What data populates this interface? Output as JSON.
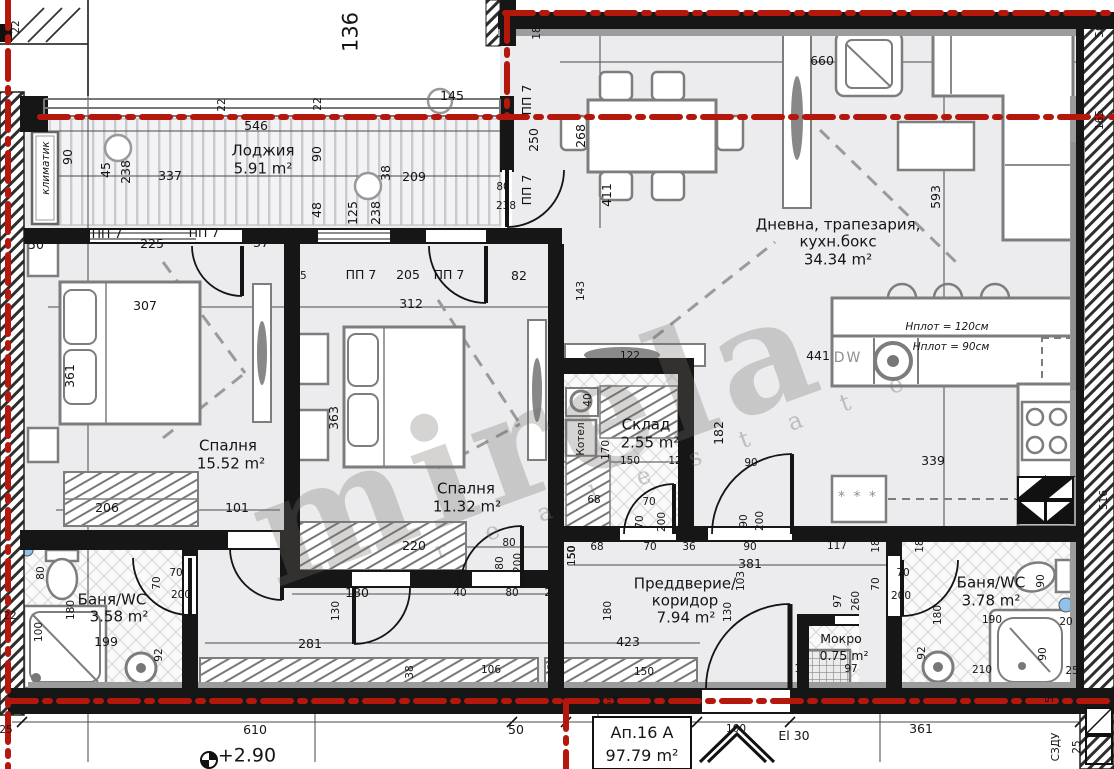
{
  "plan": {
    "apartment": {
      "name": "Ап.16 А",
      "total_area": "97.79 m²",
      "level": "+2.90",
      "entry_door_rating": "El 30"
    },
    "rooms": [
      {
        "name": "Лоджия",
        "area": "5.91 m²"
      },
      {
        "name": "Дневна, трапезария, кухн.бокс",
        "area": "34.34 m²"
      },
      {
        "name": "Спалня",
        "area": "15.52 m²"
      },
      {
        "name": "Спалня",
        "area": "11.32 m²"
      },
      {
        "name": "Склад",
        "area": "2.55 m²"
      },
      {
        "name": "Преддверие/коридор",
        "area": "7.94 m²"
      },
      {
        "name": "Баня/WC",
        "area": "3.58 m²"
      },
      {
        "name": "Баня/WC",
        "area": "3.78 m²"
      },
      {
        "name": "Мокро",
        "area": "0.75 m²"
      }
    ]
  },
  "colors": {
    "boundary_red": "#b5170d",
    "wall": "#161616",
    "furniture": "#7d7d7d"
  },
  "watermark": {
    "main": "mirela",
    "sub": "r e a l   e s t a t e"
  },
  "labels": [
    {
      "t": "22",
      "x": 16,
      "y": 27,
      "r": -90,
      "c": "sm"
    },
    {
      "t": "136",
      "x": 351,
      "y": 32,
      "r": -90,
      "c": "big"
    },
    {
      "t": "145",
      "x": 452,
      "y": 96
    },
    {
      "t": "546",
      "x": 256,
      "y": 126
    },
    {
      "t": "22",
      "x": 222,
      "y": 105,
      "r": -90,
      "c": "sm"
    },
    {
      "t": "22",
      "x": 318,
      "y": 104,
      "r": -90,
      "c": "sm"
    },
    {
      "t": "климатик",
      "x": 46,
      "y": 168,
      "r": -90,
      "c": "it",
      "n": "ac-unit-label"
    },
    {
      "t": "90",
      "x": 68,
      "y": 157,
      "r": -90
    },
    {
      "t": "45",
      "x": 106,
      "y": 170,
      "r": -90
    },
    {
      "t": "238",
      "x": 126,
      "y": 172,
      "r": -90
    },
    {
      "t": "337",
      "x": 170,
      "y": 176
    },
    {
      "t": "Лоджия",
      "x": 263,
      "y": 151,
      "c": "rm",
      "n": "room-label"
    },
    {
      "t": "5.91 m²",
      "x": 263,
      "y": 169,
      "c": "rm",
      "n": "room-area"
    },
    {
      "t": "90",
      "x": 317,
      "y": 154,
      "r": -90
    },
    {
      "t": "38",
      "x": 386,
      "y": 173,
      "r": -90
    },
    {
      "t": "209",
      "x": 414,
      "y": 177
    },
    {
      "t": "48",
      "x": 317,
      "y": 210,
      "r": -90
    },
    {
      "t": "125",
      "x": 353,
      "y": 213,
      "r": -90
    },
    {
      "t": "238",
      "x": 376,
      "y": 213,
      "r": -90
    },
    {
      "t": "80",
      "x": 503,
      "y": 187,
      "c": "sm"
    },
    {
      "t": "238",
      "x": 506,
      "y": 206,
      "c": "sm"
    },
    {
      "t": "ПП 7",
      "x": 527,
      "y": 100,
      "r": -90,
      "n": "opening-label"
    },
    {
      "t": "250",
      "x": 534,
      "y": 140,
      "r": -90
    },
    {
      "t": "ПП 7",
      "x": 527,
      "y": 190,
      "r": -90,
      "n": "opening-label"
    },
    {
      "t": "18",
      "x": 537,
      "y": 33,
      "r": -90,
      "c": "sm"
    },
    {
      "t": "57",
      "x": 552,
      "y": 236
    },
    {
      "t": "660",
      "x": 822,
      "y": 61
    },
    {
      "t": "268",
      "x": 581,
      "y": 136,
      "r": -90
    },
    {
      "t": "411",
      "x": 607,
      "y": 195,
      "r": -90
    },
    {
      "t": "593",
      "x": 936,
      "y": 197,
      "r": -90
    },
    {
      "t": "82",
      "x": 519,
      "y": 276
    },
    {
      "t": "Дневна, трапезария,",
      "x": 838,
      "y": 225,
      "c": "rm",
      "n": "room-label"
    },
    {
      "t": "кухн.бокс",
      "x": 838,
      "y": 242,
      "c": "rm"
    },
    {
      "t": "34.34 m²",
      "x": 838,
      "y": 260,
      "c": "rm",
      "n": "room-area"
    },
    {
      "t": "143",
      "x": 581,
      "y": 291,
      "r": -90,
      "c": "sm"
    },
    {
      "t": "122",
      "x": 630,
      "y": 356,
      "c": "sm"
    },
    {
      "t": "441",
      "x": 818,
      "y": 356
    },
    {
      "t": "DW",
      "x": 848,
      "y": 358,
      "c": "gray",
      "n": "dishwasher-label"
    },
    {
      "t": "Hплот = 120см",
      "x": 947,
      "y": 327,
      "c": "it",
      "n": "counter-height-label"
    },
    {
      "t": "Hплот = 90см",
      "x": 951,
      "y": 347,
      "c": "it",
      "n": "counter-height-label"
    },
    {
      "t": "339",
      "x": 933,
      "y": 461
    },
    {
      "t": "* * *",
      "x": 858,
      "y": 497,
      "c": "gray",
      "n": "fridge-label"
    },
    {
      "t": "50",
      "x": 36,
      "y": 245
    },
    {
      "t": "ПП 7",
      "x": 107,
      "y": 234,
      "n": "opening-label"
    },
    {
      "t": "225",
      "x": 152,
      "y": 244
    },
    {
      "t": "ПП 7",
      "x": 204,
      "y": 233,
      "n": "opening-label"
    },
    {
      "t": "37",
      "x": 261,
      "y": 243
    },
    {
      "t": "307",
      "x": 145,
      "y": 306
    },
    {
      "t": "361",
      "x": 70,
      "y": 376,
      "r": -90
    },
    {
      "t": "Спалня",
      "x": 228,
      "y": 446,
      "c": "rm",
      "n": "room-label"
    },
    {
      "t": "15.52 m²",
      "x": 231,
      "y": 464,
      "c": "rm",
      "n": "room-area"
    },
    {
      "t": "206",
      "x": 107,
      "y": 508
    },
    {
      "t": "101",
      "x": 237,
      "y": 508
    },
    {
      "t": "281",
      "x": 310,
      "y": 644
    },
    {
      "t": "199",
      "x": 106,
      "y": 642
    },
    {
      "t": "25",
      "x": 300,
      "y": 276,
      "c": "sm"
    },
    {
      "t": "ПП 7",
      "x": 361,
      "y": 275,
      "n": "opening-label"
    },
    {
      "t": "205",
      "x": 408,
      "y": 275
    },
    {
      "t": "ПП 7",
      "x": 449,
      "y": 275,
      "n": "opening-label"
    },
    {
      "t": "312",
      "x": 411,
      "y": 304
    },
    {
      "t": "363",
      "x": 334,
      "y": 418,
      "r": -90
    },
    {
      "t": "Спалня",
      "x": 466,
      "y": 489,
      "c": "rm",
      "n": "room-label"
    },
    {
      "t": "11.32 m²",
      "x": 467,
      "y": 507,
      "c": "rm",
      "n": "room-area"
    },
    {
      "t": "220",
      "x": 414,
      "y": 546
    },
    {
      "t": "80",
      "x": 509,
      "y": 543,
      "c": "sm"
    },
    {
      "t": "80",
      "x": 500,
      "y": 563,
      "r": -90,
      "c": "sm"
    },
    {
      "t": "200",
      "x": 518,
      "y": 563,
      "r": -90,
      "c": "sm"
    },
    {
      "t": "180",
      "x": 357,
      "y": 593
    },
    {
      "t": "40",
      "x": 460,
      "y": 593,
      "c": "sm"
    },
    {
      "t": "80",
      "x": 512,
      "y": 593,
      "c": "sm"
    },
    {
      "t": "24",
      "x": 551,
      "y": 593,
      "c": "sm"
    },
    {
      "t": "130",
      "x": 336,
      "y": 611,
      "r": -90,
      "c": "sm"
    },
    {
      "t": "38",
      "x": 410,
      "y": 672,
      "r": -90,
      "c": "sm"
    },
    {
      "t": "Склад",
      "x": 646,
      "y": 425,
      "c": "rm",
      "n": "room-label"
    },
    {
      "t": "2.55 m²",
      "x": 650,
      "y": 443,
      "c": "rm",
      "n": "room-area"
    },
    {
      "t": "182",
      "x": 719,
      "y": 433,
      "r": -90
    },
    {
      "t": "150",
      "x": 630,
      "y": 461,
      "c": "sm"
    },
    {
      "t": "12",
      "x": 675,
      "y": 461,
      "c": "sm"
    },
    {
      "t": "170",
      "x": 606,
      "y": 450,
      "r": -90,
      "c": "sm"
    },
    {
      "t": "40",
      "x": 588,
      "y": 400,
      "r": -90,
      "c": "sm"
    },
    {
      "t": "Котел",
      "x": 581,
      "y": 439,
      "r": -90,
      "c": "sm",
      "n": "boiler-label"
    },
    {
      "t": "68",
      "x": 594,
      "y": 500,
      "c": "sm"
    },
    {
      "t": "68",
      "x": 597,
      "y": 547,
      "c": "sm"
    },
    {
      "t": "50",
      "x": 572,
      "y": 552,
      "r": -90,
      "c": "sm"
    },
    {
      "t": "90",
      "x": 751,
      "y": 463,
      "c": "sm"
    },
    {
      "t": "70",
      "x": 649,
      "y": 502,
      "c": "sm"
    },
    {
      "t": "70",
      "x": 640,
      "y": 522,
      "r": -90,
      "c": "sm"
    },
    {
      "t": "200",
      "x": 662,
      "y": 522,
      "r": -90,
      "c": "sm"
    },
    {
      "t": "70",
      "x": 650,
      "y": 547,
      "c": "sm"
    },
    {
      "t": "36",
      "x": 689,
      "y": 547,
      "c": "sm"
    },
    {
      "t": "90",
      "x": 744,
      "y": 521,
      "r": -90,
      "c": "sm"
    },
    {
      "t": "200",
      "x": 760,
      "y": 521,
      "r": -90,
      "c": "sm"
    },
    {
      "t": "90",
      "x": 750,
      "y": 547,
      "c": "sm"
    },
    {
      "t": "381",
      "x": 750,
      "y": 564
    },
    {
      "t": "103",
      "x": 741,
      "y": 581,
      "r": -90,
      "c": "sm"
    },
    {
      "t": "Преддверие/",
      "x": 685,
      "y": 584,
      "c": "rm",
      "n": "room-label"
    },
    {
      "t": "коридор",
      "x": 685,
      "y": 601,
      "c": "rm"
    },
    {
      "t": "7.94 m²",
      "x": 686,
      "y": 618,
      "c": "rm",
      "n": "room-area"
    },
    {
      "t": "423",
      "x": 628,
      "y": 642
    },
    {
      "t": "150",
      "x": 644,
      "y": 672,
      "c": "sm"
    },
    {
      "t": "106",
      "x": 491,
      "y": 670,
      "c": "sm"
    },
    {
      "t": "50",
      "x": 553,
      "y": 670,
      "c": "sm"
    },
    {
      "t": "130",
      "x": 728,
      "y": 612,
      "r": -90,
      "c": "sm"
    },
    {
      "t": "180",
      "x": 608,
      "y": 611,
      "r": -90,
      "c": "sm"
    },
    {
      "t": "150",
      "x": 572,
      "y": 556,
      "r": -90,
      "c": "sm"
    },
    {
      "t": "25",
      "x": 612,
      "y": 701,
      "r": -90,
      "c": "sm"
    },
    {
      "t": "97",
      "x": 838,
      "y": 601,
      "r": -90,
      "c": "sm"
    },
    {
      "t": "260",
      "x": 856,
      "y": 601,
      "r": -90,
      "c": "sm"
    },
    {
      "t": "Мокро",
      "x": 841,
      "y": 639,
      "c": "rmsm",
      "n": "room-label"
    },
    {
      "t": "0.75 m²",
      "x": 844,
      "y": 656,
      "c": "rmsm",
      "n": "room-area"
    },
    {
      "t": "15",
      "x": 801,
      "y": 669,
      "c": "sm"
    },
    {
      "t": "97",
      "x": 851,
      "y": 669,
      "c": "sm"
    },
    {
      "t": "117",
      "x": 837,
      "y": 546,
      "c": "sm"
    },
    {
      "t": "18",
      "x": 876,
      "y": 546,
      "r": -90,
      "c": "sm"
    },
    {
      "t": "18",
      "x": 920,
      "y": 546,
      "r": -90,
      "c": "sm"
    },
    {
      "t": "70",
      "x": 903,
      "y": 573,
      "c": "sm"
    },
    {
      "t": "200",
      "x": 901,
      "y": 596,
      "c": "sm"
    },
    {
      "t": "70",
      "x": 876,
      "y": 584,
      "r": -90,
      "c": "sm"
    },
    {
      "t": "Баня/WC",
      "x": 991,
      "y": 583,
      "c": "rm",
      "n": "room-label"
    },
    {
      "t": "3.78 m²",
      "x": 991,
      "y": 601,
      "c": "rm",
      "n": "room-area"
    },
    {
      "t": "180",
      "x": 938,
      "y": 615,
      "r": -90,
      "c": "sm"
    },
    {
      "t": "92",
      "x": 922,
      "y": 653,
      "r": -90,
      "c": "sm"
    },
    {
      "t": "190",
      "x": 992,
      "y": 620,
      "c": "sm"
    },
    {
      "t": "210",
      "x": 982,
      "y": 670,
      "c": "sm"
    },
    {
      "t": "90",
      "x": 1041,
      "y": 581,
      "r": -90,
      "c": "sm"
    },
    {
      "t": "90",
      "x": 1043,
      "y": 654,
      "r": -90,
      "c": "sm"
    },
    {
      "t": "20",
      "x": 1066,
      "y": 622,
      "c": "sm"
    },
    {
      "t": "25",
      "x": 1072,
      "y": 671,
      "c": "sm"
    },
    {
      "t": "25",
      "x": 1050,
      "y": 703,
      "r": -90,
      "c": "sm"
    },
    {
      "t": "Баня/WC",
      "x": 112,
      "y": 600,
      "c": "rm",
      "n": "room-label"
    },
    {
      "t": "3.58 m²",
      "x": 119,
      "y": 617,
      "c": "rm",
      "n": "room-area"
    },
    {
      "t": "80",
      "x": 41,
      "y": 573,
      "r": -90,
      "c": "sm"
    },
    {
      "t": "180",
      "x": 71,
      "y": 610,
      "r": -90,
      "c": "sm"
    },
    {
      "t": "22",
      "x": 10,
      "y": 616,
      "c": "sm"
    },
    {
      "t": "100",
      "x": 39,
      "y": 632,
      "r": -90,
      "c": "sm"
    },
    {
      "t": "70",
      "x": 176,
      "y": 573,
      "c": "sm"
    },
    {
      "t": "200",
      "x": 181,
      "y": 595,
      "c": "sm"
    },
    {
      "t": "70",
      "x": 157,
      "y": 583,
      "r": -90,
      "c": "sm"
    },
    {
      "t": "18",
      "x": 161,
      "y": 544,
      "r": -90,
      "c": "sm"
    },
    {
      "t": "92",
      "x": 159,
      "y": 655,
      "r": -90,
      "c": "sm"
    },
    {
      "t": "610",
      "x": 255,
      "y": 730
    },
    {
      "t": "+2.90",
      "x": 247,
      "y": 756,
      "c": "lvl",
      "n": "level-label"
    },
    {
      "t": "25",
      "x": 6,
      "y": 730,
      "c": "sm"
    },
    {
      "t": "50",
      "x": 516,
      "y": 730
    },
    {
      "t": "Ап.16 А",
      "x": 642,
      "y": 733,
      "c": "apt",
      "n": "apartment-label"
    },
    {
      "t": "97.79 m²",
      "x": 642,
      "y": 756,
      "c": "apt",
      "n": "apartment-area"
    },
    {
      "t": "100",
      "x": 736,
      "y": 729,
      "c": "sm"
    },
    {
      "t": "El 30",
      "x": 794,
      "y": 736,
      "n": "door-rating-label"
    },
    {
      "t": "361",
      "x": 921,
      "y": 729
    },
    {
      "t": "СЗДУ",
      "x": 1056,
      "y": 747,
      "r": -90,
      "c": "sm",
      "n": "shaft-label"
    },
    {
      "t": "25",
      "x": 1077,
      "y": 747,
      "r": -90,
      "c": "sm"
    },
    {
      "t": "50",
      "x": 1100,
      "y": 31,
      "r": -90,
      "c": "sm"
    },
    {
      "t": "165",
      "x": 1100,
      "y": 120,
      "r": -90,
      "c": "sm"
    },
    {
      "t": "516",
      "x": 1104,
      "y": 500,
      "r": -90,
      "c": "sm"
    }
  ]
}
